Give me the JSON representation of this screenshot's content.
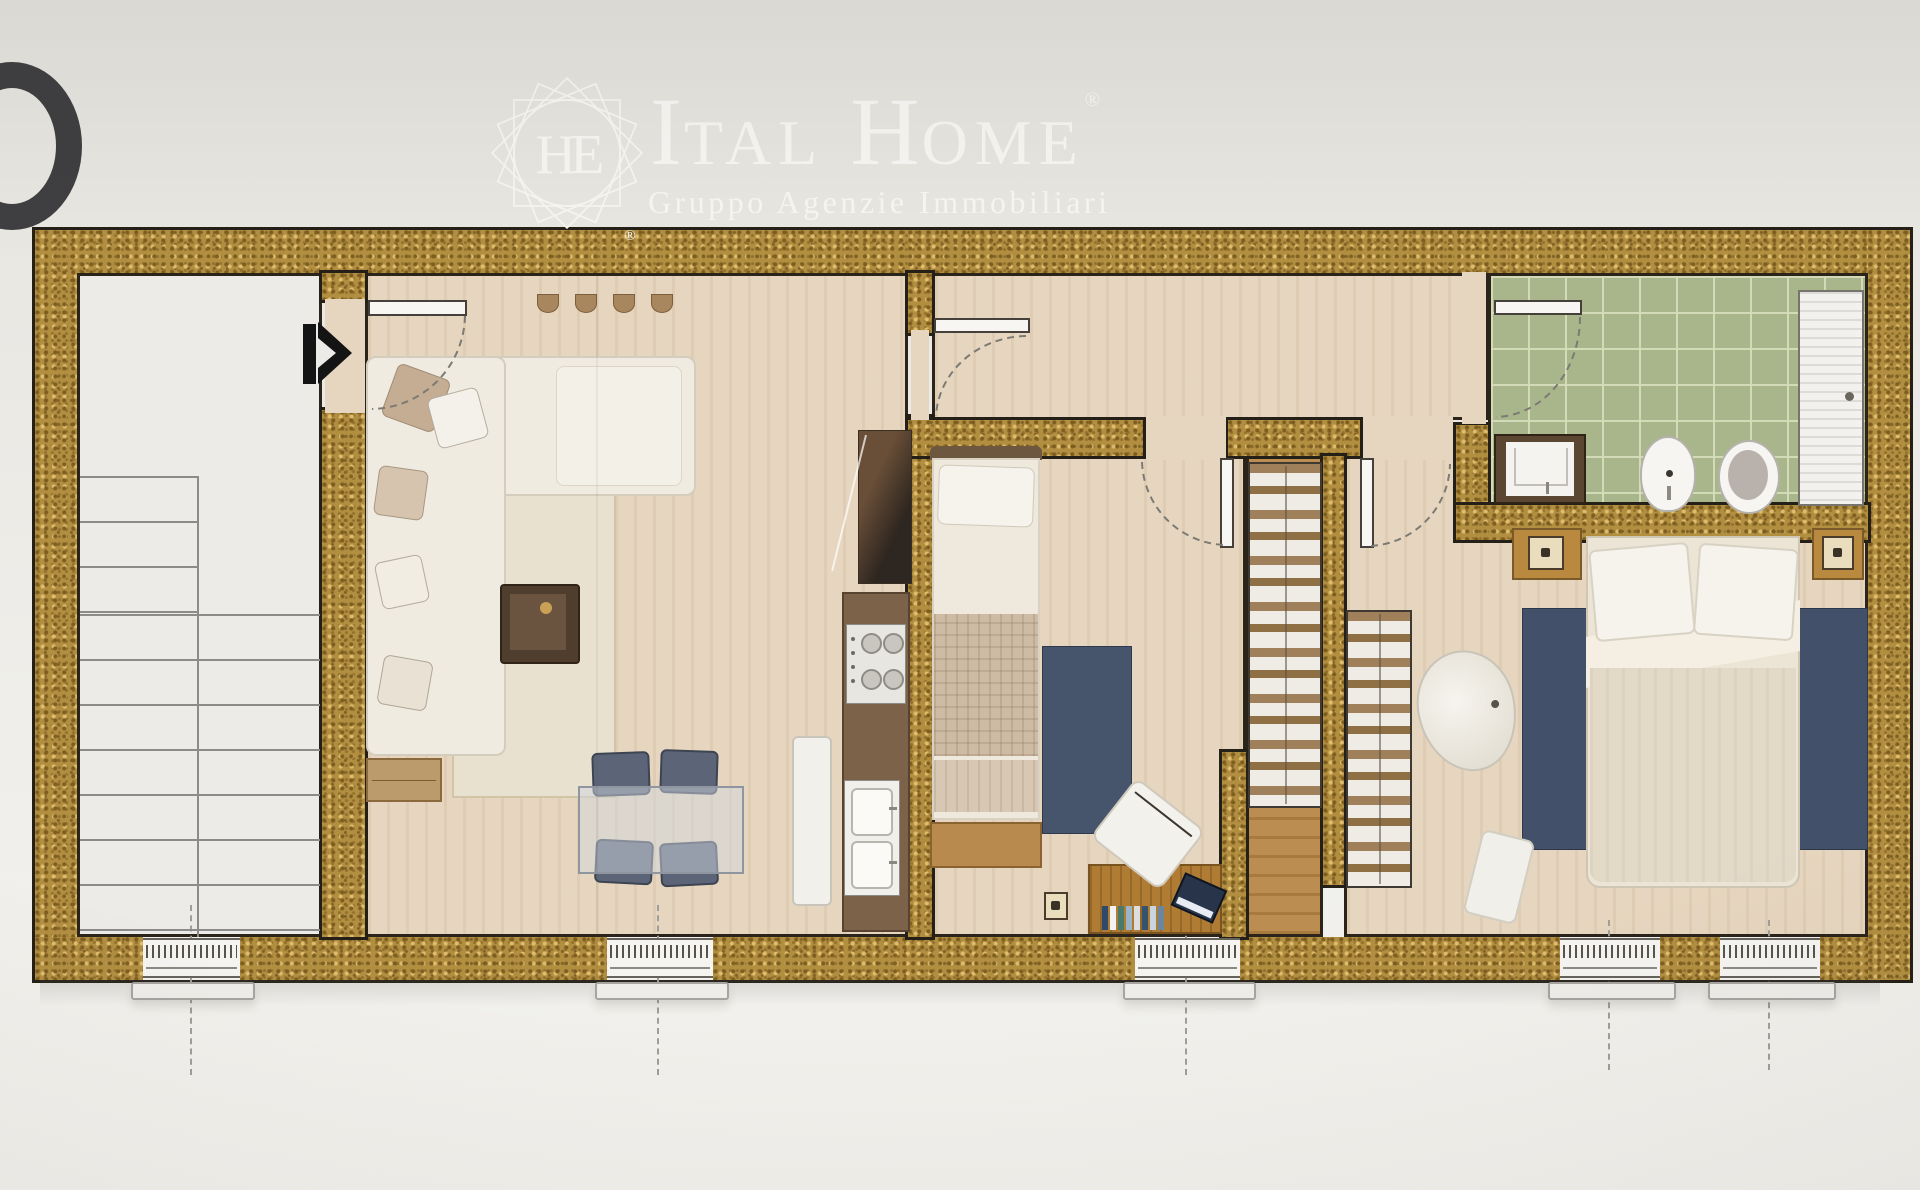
{
  "header": {
    "edge_glyph": "O",
    "emblem": {
      "monogram": "HE",
      "registered": "®"
    },
    "brand": {
      "word1_initial": "I",
      "word1_rest": "TAL",
      "word2_initial": "H",
      "word2_rest": "OME",
      "registered": "®"
    },
    "subtitle": "Gruppo Agenzie Immobiliari"
  },
  "palette": {
    "wall_gold": "#b28e41",
    "outline_black": "#241f17",
    "floor_wood": "#e6d6bf",
    "tile_green": "#a9b68c",
    "rug_blue": "#44536b",
    "stair_white": "#ecebe8",
    "oak_wood": "#b98a4e",
    "paper_gray": "#e9e7e2"
  }
}
